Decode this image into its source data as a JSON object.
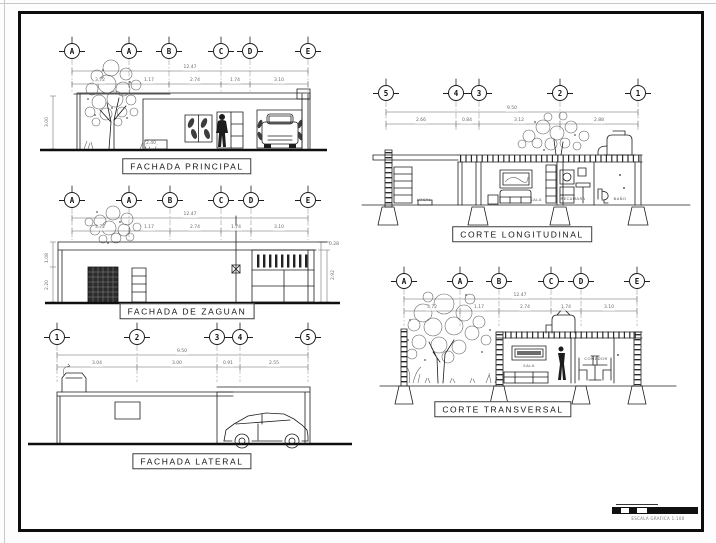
{
  "sheet": {
    "ink": "#1c1c1c",
    "frame_color": "#0d0d0d"
  },
  "views": {
    "fachada_principal": {
      "title": "FACHADA PRINCIPAL",
      "axes": [
        {
          "label": "A",
          "x": 72,
          "y": 51
        },
        {
          "label": "A",
          "x": 129,
          "y": 51
        },
        {
          "label": "B",
          "x": 169,
          "y": 51
        },
        {
          "label": "C",
          "x": 221,
          "y": 51
        },
        {
          "label": "D",
          "x": 250,
          "y": 51
        },
        {
          "label": "E",
          "x": 308,
          "y": 51
        }
      ],
      "dims": [
        {
          "text": "12.47",
          "x": 190,
          "y": 68
        },
        {
          "text": "3.72",
          "x": 100,
          "y": 81
        },
        {
          "text": "1.17",
          "x": 149,
          "y": 81
        },
        {
          "text": "2.74",
          "x": 195,
          "y": 81
        },
        {
          "text": "1.74",
          "x": 235,
          "y": 81
        },
        {
          "text": "3.10",
          "x": 279,
          "y": 81
        },
        {
          "text": "3.00",
          "x": 48,
          "y": 122,
          "rot": 1
        },
        {
          "text": "2.40",
          "x": 151,
          "y": 144
        }
      ]
    },
    "fachada_zaguan": {
      "title": "FACHADA DE ZAGUAN",
      "axes": [
        {
          "label": "A",
          "x": 72,
          "y": 200
        },
        {
          "label": "A",
          "x": 129,
          "y": 200
        },
        {
          "label": "B",
          "x": 170,
          "y": 200
        },
        {
          "label": "C",
          "x": 221,
          "y": 200
        },
        {
          "label": "D",
          "x": 251,
          "y": 200
        },
        {
          "label": "E",
          "x": 308,
          "y": 200
        }
      ],
      "dims": [
        {
          "text": "12.47",
          "x": 190,
          "y": 215
        },
        {
          "text": "3.72",
          "x": 100,
          "y": 228
        },
        {
          "text": "1.17",
          "x": 149,
          "y": 228
        },
        {
          "text": "2.74",
          "x": 195,
          "y": 228
        },
        {
          "text": "1.74",
          "x": 236,
          "y": 228
        },
        {
          "text": "3.10",
          "x": 279,
          "y": 228
        },
        {
          "text": "1.08",
          "x": 48,
          "y": 258,
          "rot": 1
        },
        {
          "text": "2.20",
          "x": 48,
          "y": 285,
          "rot": 1
        },
        {
          "text": "0.28",
          "x": 334,
          "y": 245
        },
        {
          "text": "2.92",
          "x": 334,
          "y": 275,
          "rot": 1
        }
      ]
    },
    "fachada_lateral": {
      "title": "FACHADA LATERAL",
      "axes": [
        {
          "label": "1",
          "x": 57,
          "y": 337
        },
        {
          "label": "2",
          "x": 137,
          "y": 337
        },
        {
          "label": "3",
          "x": 217,
          "y": 337
        },
        {
          "label": "4",
          "x": 240,
          "y": 337
        },
        {
          "label": "5",
          "x": 308,
          "y": 337
        }
      ],
      "dims": [
        {
          "text": "9.50",
          "x": 182,
          "y": 352
        },
        {
          "text": "3.04",
          "x": 97,
          "y": 364
        },
        {
          "text": "3.00",
          "x": 177,
          "y": 364
        },
        {
          "text": "0.91",
          "x": 228,
          "y": 364
        },
        {
          "text": "2.55",
          "x": 274,
          "y": 364
        }
      ]
    },
    "corte_longitudinal": {
      "title": "CORTE LONGITUDINAL",
      "axes": [
        {
          "label": "5",
          "x": 386,
          "y": 93
        },
        {
          "label": "4",
          "x": 456,
          "y": 93
        },
        {
          "label": "3",
          "x": 479,
          "y": 93
        },
        {
          "label": "2",
          "x": 560,
          "y": 93
        },
        {
          "label": "1",
          "x": 638,
          "y": 93
        }
      ],
      "dims": [
        {
          "text": "9.50",
          "x": 512,
          "y": 109
        },
        {
          "text": "2.66",
          "x": 421,
          "y": 121
        },
        {
          "text": "0.84",
          "x": 467,
          "y": 121
        },
        {
          "text": "3.12",
          "x": 519,
          "y": 121
        },
        {
          "text": "2.88",
          "x": 599,
          "y": 121
        }
      ],
      "rooms": [
        {
          "text": "LOCAL",
          "x": 424,
          "y": 200
        },
        {
          "text": "SALA",
          "x": 536,
          "y": 200
        },
        {
          "text": "RECAMARA",
          "x": 573,
          "y": 199
        },
        {
          "text": "BAÑO",
          "x": 620,
          "y": 199
        }
      ]
    },
    "corte_transversal": {
      "title": "CORTE TRANSVERSAL",
      "axes": [
        {
          "label": "A",
          "x": 404,
          "y": 281
        },
        {
          "label": "A",
          "x": 460,
          "y": 281
        },
        {
          "label": "B",
          "x": 499,
          "y": 281
        },
        {
          "label": "C",
          "x": 551,
          "y": 281
        },
        {
          "label": "D",
          "x": 581,
          "y": 281
        },
        {
          "label": "E",
          "x": 637,
          "y": 281
        }
      ],
      "dims": [
        {
          "text": "12.47",
          "x": 520,
          "y": 296
        },
        {
          "text": "3.72",
          "x": 432,
          "y": 308
        },
        {
          "text": "1.17",
          "x": 479,
          "y": 308
        },
        {
          "text": "2.74",
          "x": 525,
          "y": 308
        },
        {
          "text": "1.74",
          "x": 566,
          "y": 308
        },
        {
          "text": "3.10",
          "x": 609,
          "y": 308
        }
      ],
      "rooms": [
        {
          "text": "SALA",
          "x": 529,
          "y": 366
        },
        {
          "text": "COMEDOR",
          "x": 596,
          "y": 359
        }
      ]
    }
  },
  "scale_bar": {
    "label": "ESCALA GRAFICA 1:100"
  }
}
